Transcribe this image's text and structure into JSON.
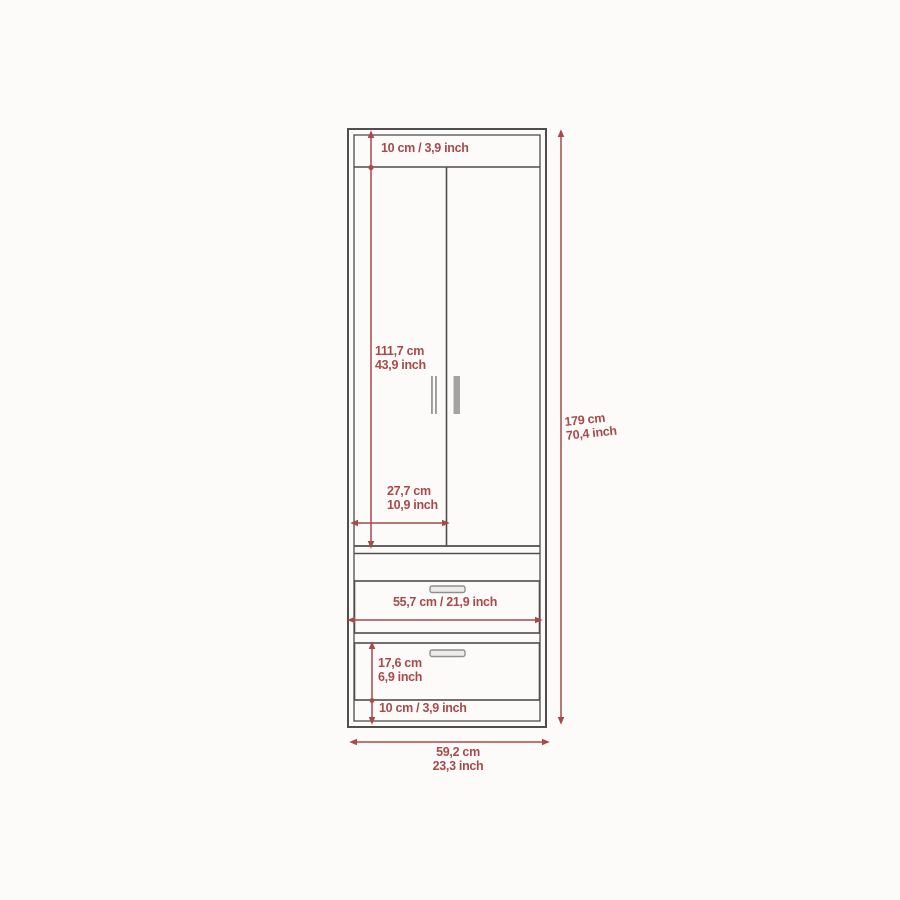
{
  "diagram": {
    "kind": "furniture-dimension-diagram",
    "colors": {
      "dimension_red": "#a84a4a",
      "outline_gray": "#4e4e4e",
      "handle_gray": "#9b9b9b",
      "background": "#fcfbfa"
    },
    "dimensions": {
      "top_panel": {
        "label": "10 cm / 3,9 inch"
      },
      "door_height": {
        "cm": "111,7 cm",
        "inch": "43,9 inch"
      },
      "door_width": {
        "cm": "27,7 cm",
        "inch": "10,9 inch"
      },
      "total_height": {
        "cm": "179 cm",
        "inch": "70,4 inch"
      },
      "drawer_width": {
        "label": "55,7 cm / 21,9 inch"
      },
      "drawer_height": {
        "cm": "17,6 cm",
        "inch": "6,9 inch"
      },
      "base_panel": {
        "label": "10 cm / 3,9 inch"
      },
      "total_width": {
        "cm": "59,2 cm",
        "inch": "23,3 inch"
      }
    }
  }
}
